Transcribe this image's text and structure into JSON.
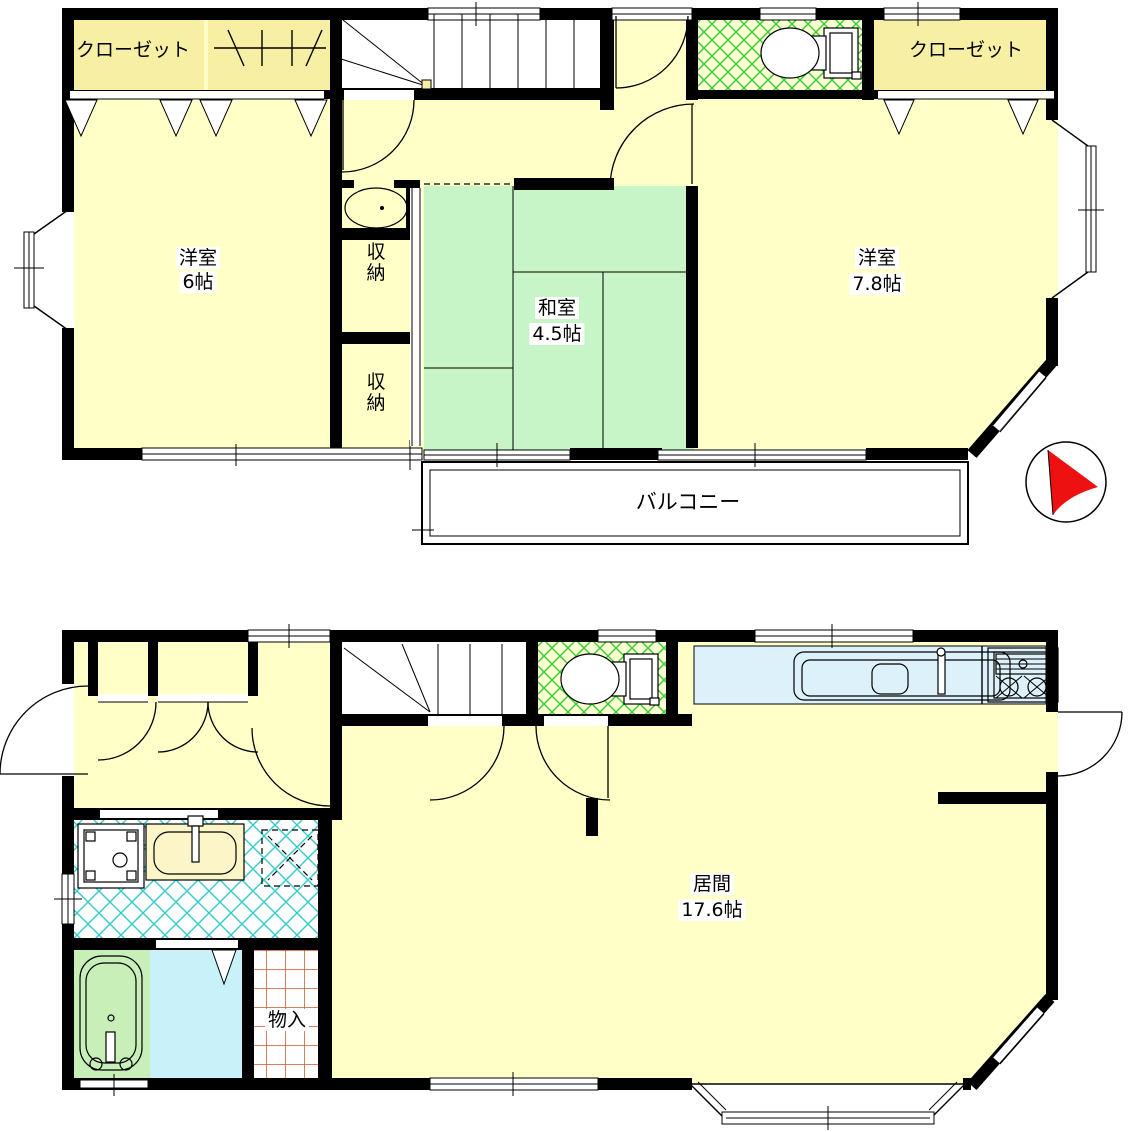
{
  "floor2": {
    "closet_left_label": "クローゼット",
    "closet_right_label": "クローゼット",
    "room_west_name": "洋室",
    "room_west_size": "6帖",
    "storage1_label": "収納",
    "storage2_label": "収納",
    "tatami_name": "和室",
    "tatami_size": "4.5帖",
    "room_east_name": "洋室",
    "room_east_size": "7.8帖",
    "balcony_label": "バルコニー"
  },
  "floor1": {
    "living_name": "居間",
    "living_size": "17.6帖",
    "storage_label": "物入"
  },
  "colors": {
    "wall": "#000000",
    "room_yellow": "#FFFFC8",
    "closet_yellow": "#F7EFA3",
    "tatami_green": "#C8F5C8",
    "toilet_hatch_green": "#33CC33",
    "toilet_bg": "#FAFFD2",
    "wash_hatch_cyan": "#33CCCC",
    "bath_floor_blue": "#C9F1FA",
    "tub_green": "#C9EFB9",
    "storage_grid_orange": "#C8552B",
    "counter_blue": "#DCF1FA",
    "compass_red": "#EE1111"
  }
}
